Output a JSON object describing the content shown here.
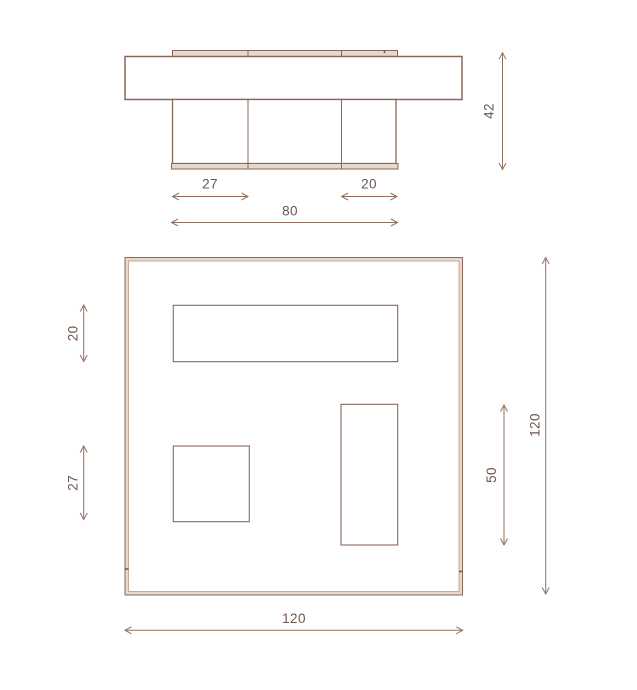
{
  "views": {
    "elevation": {
      "dimensions": {
        "left_leg_width": "27",
        "right_leg_width": "20",
        "legs_span": "80",
        "total_height": "42"
      }
    },
    "plan": {
      "dimensions": {
        "top_slot_depth": "20",
        "square_leg_size": "27",
        "side_slot_length": "50",
        "side_length": "120",
        "front_width": "120"
      }
    }
  },
  "colors": {
    "outline": "#8a675a",
    "band_fill": "#e7d8cd",
    "inner_line": "#bfa290",
    "dimension_line": "#93705f",
    "label_text": "#6b544a",
    "background": "#ffffff"
  }
}
